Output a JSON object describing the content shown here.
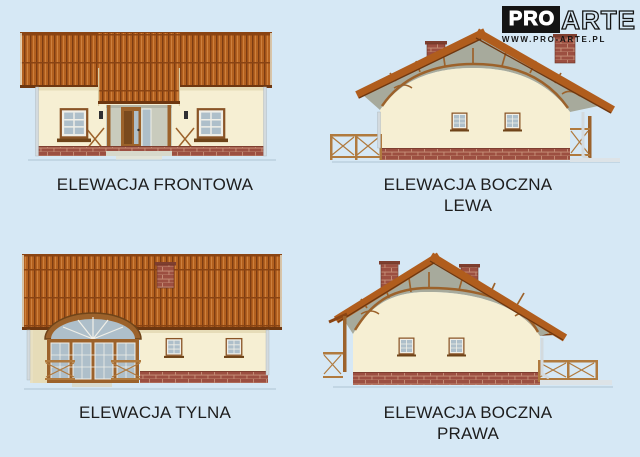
{
  "logo": {
    "brand_pro": "PRO",
    "brand_arte": "ARTE",
    "website": "WWW.PRO-ARTE.PL"
  },
  "elevations": [
    {
      "name": "frontowa",
      "caption_line1": "ELEWACJA FRONTOWA",
      "caption_line2": ""
    },
    {
      "name": "boczna-lewa",
      "caption_line1": "ELEWACJA BOCZNA",
      "caption_line2": "LEWA"
    },
    {
      "name": "tylna",
      "caption_line1": "ELEWACJA TYLNA",
      "caption_line2": ""
    },
    {
      "name": "boczna-prawa",
      "caption_line1": "ELEWACJA BOCZNA",
      "caption_line2": "PRAWA"
    }
  ],
  "colors": {
    "background": "#d6e8f5",
    "text": "#1d1d1d",
    "logo_black": "#141414",
    "roof_tile": "#b4611f",
    "roof_tile_dark": "#7c3c12",
    "roof_tile_light": "#d08440",
    "roof_edge": "#6e3710",
    "wall": "#f6efd3",
    "wall_shade": "#e6dcb8",
    "gable_infill": "#a7aa9c",
    "wood": "#9c622b",
    "wood_dark": "#6f4419",
    "brick": "#9c4f41",
    "mortar": "#c79179",
    "window_pane": "#aebfca",
    "frame_white": "#f0efe8",
    "downspout": "#d3dade",
    "ground_shadow": "#b9cedd",
    "terrace": "#dde3e7"
  }
}
